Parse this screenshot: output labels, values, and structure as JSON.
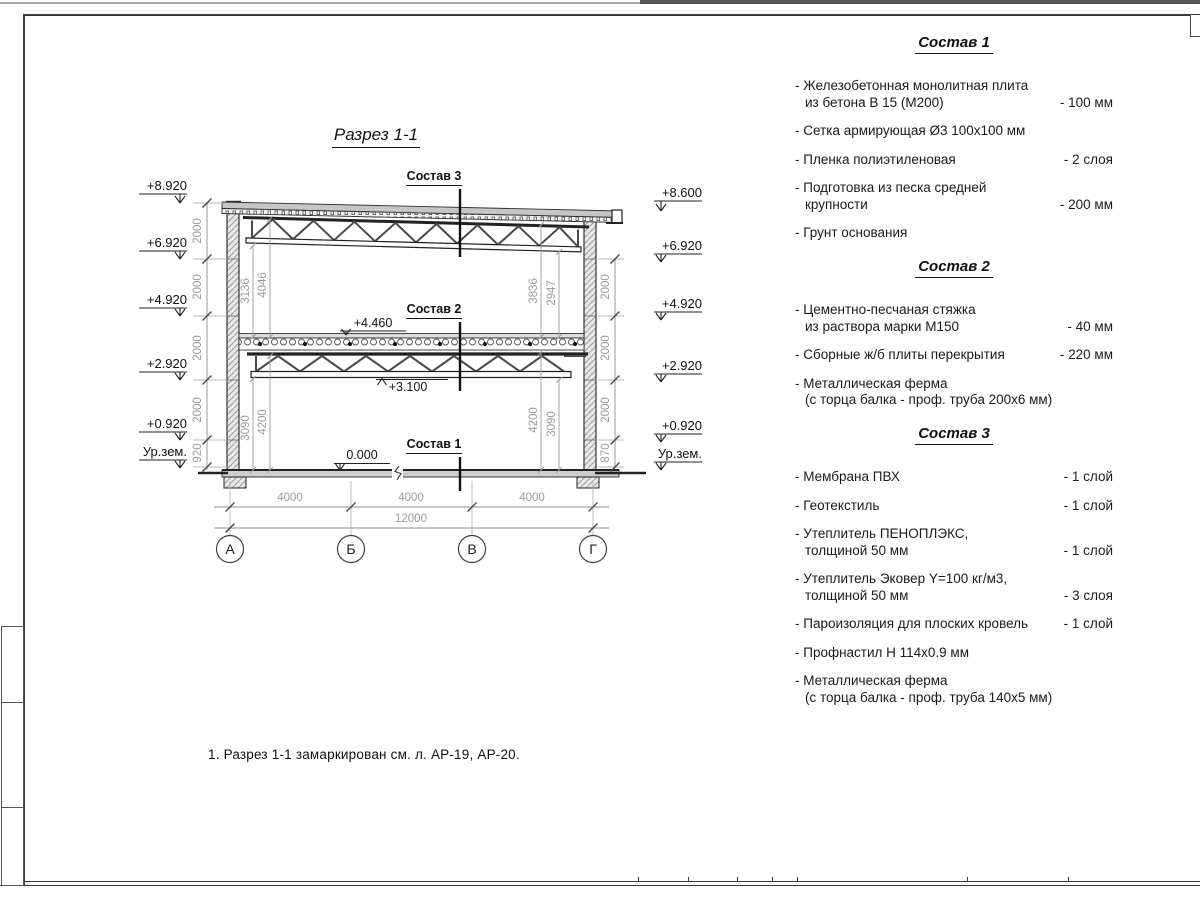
{
  "page": {
    "title": "Разрез 1-1",
    "note": "1. Разрез 1-1 замаркирован см. л. АР-19, АР-20."
  },
  "drawing": {
    "composition_labels": {
      "c1": "Состав 1",
      "c2": "Состав 2",
      "c3": "Состав 3"
    },
    "elevations_left": [
      "+8.920",
      "+6.920",
      "+4.920",
      "+2.920",
      "+0.920",
      "Ур.зем."
    ],
    "elevations_right": [
      "+8.600",
      "+6.920",
      "+4.920",
      "+2.920",
      "+0.920",
      "Ур.зем."
    ],
    "dims_left": [
      "2000",
      "2000",
      "2000",
      "2000",
      "920"
    ],
    "dims_right": [
      "2000",
      "2000",
      "2000",
      "870"
    ],
    "inner_dims_left": {
      "upper": [
        "3136",
        "4046"
      ],
      "lower": [
        "3090",
        "4200"
      ]
    },
    "inner_dims_right": {
      "upper": [
        "3836",
        "2947"
      ],
      "lower": [
        "4200",
        "3090"
      ]
    },
    "levels": {
      "floor2_top": "+4.460",
      "truss2_bottom": "+3.100",
      "floor1_top": "0.000"
    },
    "axis_dims": [
      "4000",
      "4000",
      "4000"
    ],
    "overall_dim": "12000",
    "axes": [
      "А",
      "Б",
      "В",
      "Г"
    ]
  },
  "specs": [
    {
      "title": "Состав 1",
      "items": [
        {
          "text": "- Железобетонная  монолитная плита",
          "text2": "из бетона В 15 (М200)",
          "value": "- 100 мм"
        },
        {
          "text": "- Сетка армирующая Ø3 100х100 мм",
          "text2": "",
          "value": ""
        },
        {
          "text": "- Пленка полиэтиленовая",
          "text2": "",
          "value": "-  2 слоя"
        },
        {
          "text": "- Подготовка из песка средней",
          "text2": "крупности",
          "value": "- 200 мм"
        },
        {
          "text": "- Грунт основания",
          "text2": "",
          "value": ""
        }
      ]
    },
    {
      "title": "Состав 2",
      "items": [
        {
          "text": "- Цементно-песчаная стяжка",
          "text2": "из раствора марки М150",
          "value": "- 40 мм"
        },
        {
          "text": "- Сборные ж/б плиты перекрытия",
          "text2": "",
          "value": "- 220 мм"
        },
        {
          "text": "- Металлическая ферма",
          "text2": "(с торца балка - проф. труба 200х6 мм)",
          "value": ""
        }
      ]
    },
    {
      "title": "Состав 3",
      "items": [
        {
          "text": "- Мембрана ПВХ",
          "text2": "",
          "value": "- 1 слой"
        },
        {
          "text": "- Геотекстиль",
          "text2": "",
          "value": "- 1 слой"
        },
        {
          "text": "- Утеплитель ПЕНОПЛЭКС,",
          "text2": "толщиной 50 мм",
          "value": "- 1 слой"
        },
        {
          "text": "- Утеплитель Эковер Y=100 кг/м3,",
          "text2": "толщиной 50 мм",
          "value": "- 3 слоя"
        },
        {
          "text": "- Пароизоляция для плоских кровель",
          "text2": "",
          "value": "- 1 слой"
        },
        {
          "text": "- Профнастил Н 114х0.9 мм",
          "text2": "",
          "value": ""
        },
        {
          "text": "- Металлическая ферма",
          "text2": "(с торца балка - проф. труба 140х5 мм)",
          "value": ""
        }
      ]
    }
  ]
}
